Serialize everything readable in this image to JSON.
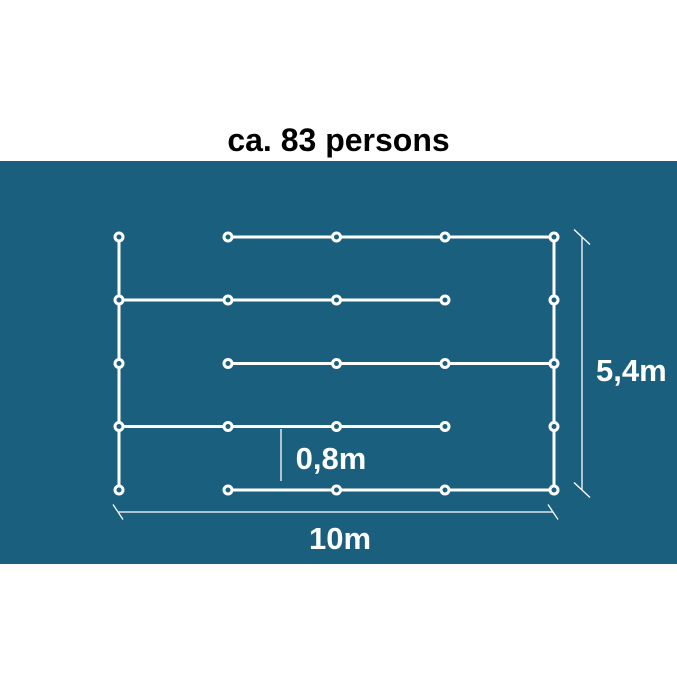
{
  "title": "ca. 83 persons",
  "colors": {
    "page_background": "#ffffff",
    "panel_background": "#1B5F7E",
    "queue_line": "#ffffff",
    "node_ring": "#ffffff",
    "dimension_line": "#ffffff",
    "title_text": "#000000",
    "dimension_text": "#ffffff"
  },
  "diagram": {
    "panel": {
      "top": 161,
      "height": 403,
      "width": 677
    },
    "grid": {
      "columns_x": [
        119,
        228,
        336.5,
        445,
        554
      ],
      "rows_y": [
        237,
        300,
        363.5,
        426.5,
        490
      ]
    },
    "queue_line_width": 3,
    "node_style": {
      "radius": 4,
      "stroke_width": 3
    },
    "horizontal_segments": [
      {
        "row": 0,
        "from_col": 1,
        "to_col": 4
      },
      {
        "row": 1,
        "from_col": 0,
        "to_col": 3
      },
      {
        "row": 2,
        "from_col": 1,
        "to_col": 4
      },
      {
        "row": 3,
        "from_col": 0,
        "to_col": 3
      },
      {
        "row": 4,
        "from_col": 1,
        "to_col": 4
      }
    ],
    "vertical_segments": [
      {
        "col": 0,
        "from_row": 0,
        "to_row": 4
      },
      {
        "col": 4,
        "from_row": 0,
        "to_row": 4
      }
    ],
    "dimensions": {
      "height": {
        "label": "5,4m",
        "line_x": 582,
        "from_y": 237,
        "to_y": 490,
        "ticks": true,
        "tick_dx": 8,
        "tick_dy": 7.5
      },
      "width": {
        "label": "10m",
        "line_y": 512,
        "from_x": 118,
        "to_x": 553,
        "ticks": true,
        "tick_dx": 5,
        "tick_dy": 7.5
      },
      "row_gap": {
        "label": "0,8m",
        "line_x": 281,
        "from_y": 429,
        "to_y": 481,
        "ticks": false
      }
    },
    "dimension_line_width": 1.3
  }
}
